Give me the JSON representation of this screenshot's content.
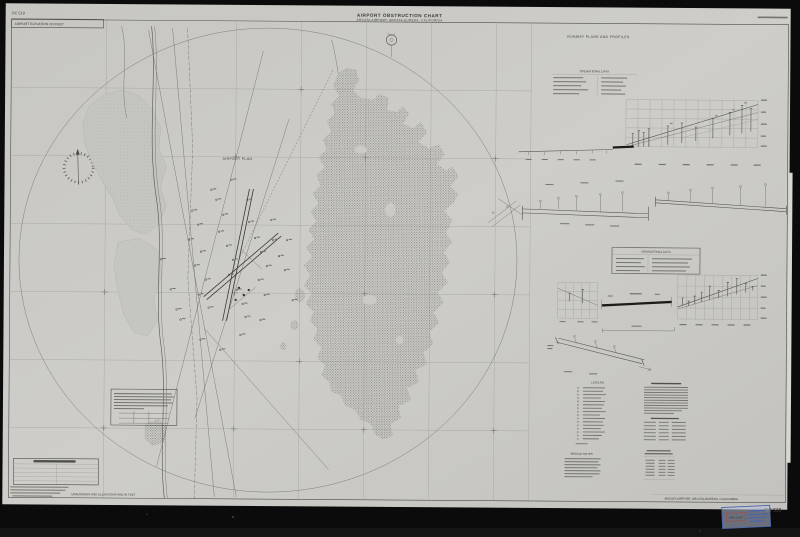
{
  "colors": {
    "paper": "#cbcac6",
    "ink": "#3a3a34",
    "background": "#0b0b0b",
    "stamp_blue": "#4a66aa",
    "stamp_red": "#b2423a"
  },
  "header": {
    "oc_number": "OC 519",
    "airport_elevation_label": "AIRPORT ELEVATION 218 FEET",
    "title": "AIRPORT OBSTRUCTION CHART",
    "subtitle": "ARCATA AIRPORT, ARCATA-EUREKA, CALIFORNIA"
  },
  "map": {
    "airport_plan_label": "AIRPORT PLAN",
    "dimensions_note": "DIMENSIONS AND ELEVATIONS ARE IN FEET"
  },
  "right_panel": {
    "section_title": "RUNWAY PLANS AND PROFILES",
    "operational_data_label": "OPERATIONAL DATA",
    "legend_label": "LEGEND",
    "special_notes_label": "SPECIAL NOTES"
  },
  "footer": {
    "airport_title": "ARCATA AIRPORT, ARCATA-EUREKA, CALIFORNIA",
    "oc_number": "OC 519",
    "stamp_date": "FEB 18 80"
  }
}
